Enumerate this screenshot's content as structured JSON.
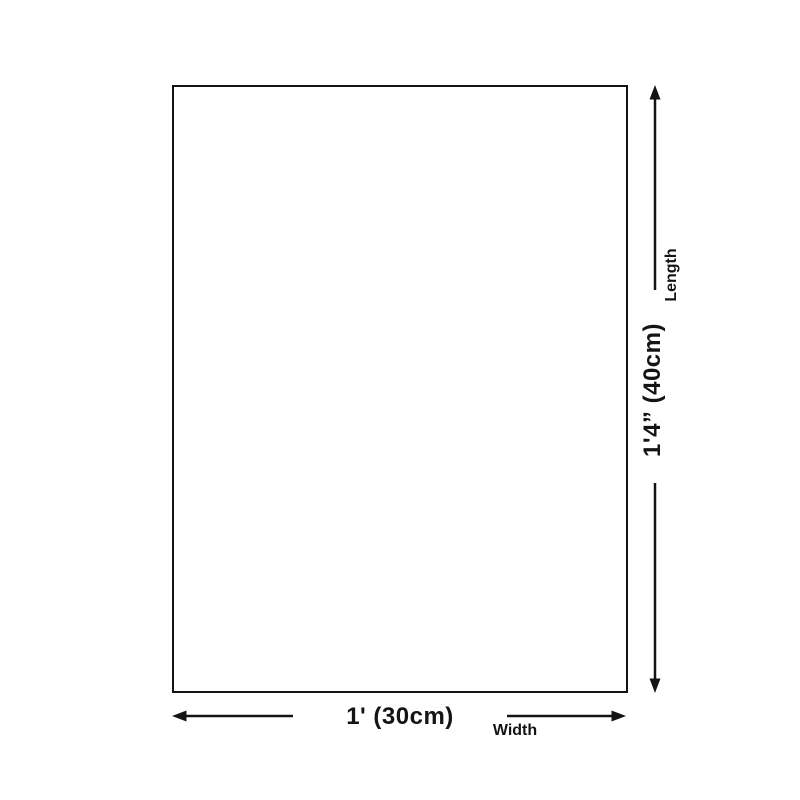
{
  "diagram": {
    "length": {
      "value": "1'4” (40cm)",
      "label": "Length"
    },
    "width": {
      "value": "1' (30cm)",
      "label": "Width"
    },
    "colors": {
      "line": "#141414",
      "background": "#ffffff"
    }
  }
}
